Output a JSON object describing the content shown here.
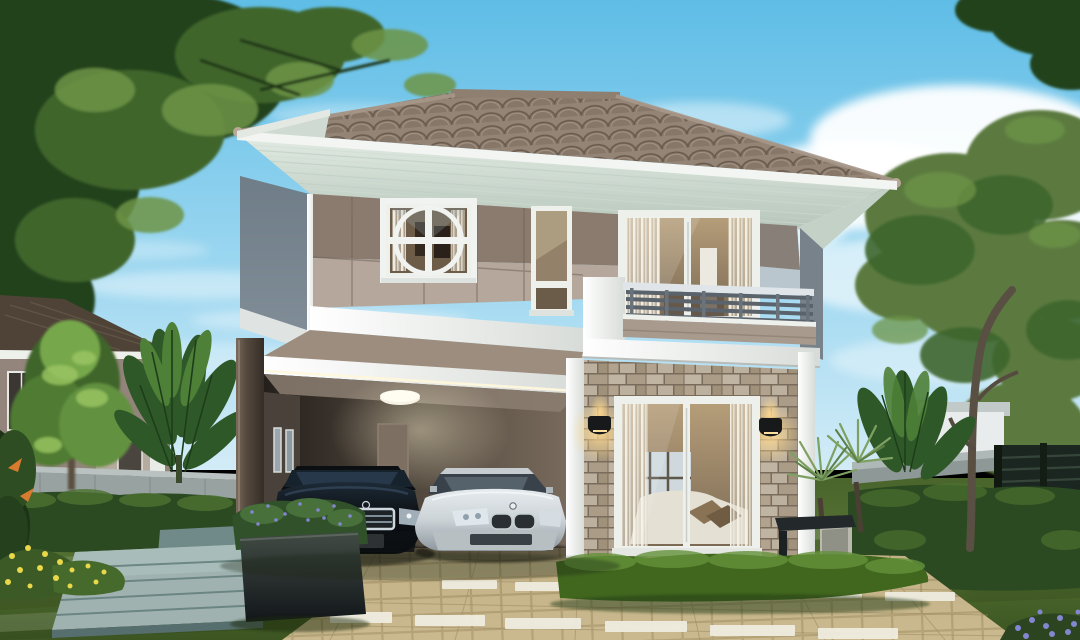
{
  "scene": {
    "description": "Architectural rendering of a modern two-story house at dusk with a carport, two sedans, stone-clad facade, balcony, landscaped garden and paver driveway",
    "objects": {
      "sky": "Blue sky with soft clouds",
      "left_tree": "Large green tree canopy, top left",
      "right_tree": "Tall olive-green garden tree, right side",
      "neighbor_house": "Neighboring two-story house, left background",
      "perimeter_wall": "Gray concrete perimeter wall",
      "metal_fence": "Dark slatted metal fence, right",
      "main_house": "Two-story house with hip tile roof",
      "roof": "Brown concrete tile hip roof with finials",
      "soffit": "White-green striped eave soffit",
      "upper_facade": "Two-tone taupe panel facade",
      "circle_window": "Square window with circular white mullion motif",
      "tall_window": "Tall narrow two-pane window",
      "balcony_door": "White-framed sliding glass door to balcony",
      "balcony": "Balcony with white pillar, metal railing and taupe parapet",
      "carport": "Covered carport with ceiling lamp",
      "ceiling_lamp": "Round ceiling light",
      "black_car": "Black luxury sedan",
      "silver_car": "Silver sedan",
      "stone_wall": "Stacked-stone veneer wall",
      "glass_door": "Large sliding glass door with sheer curtains and living room view",
      "wall_lamps": "Two black wall sconces with warm glow",
      "bench": "Dark-top garden bench on concrete base",
      "driveway": "Tan paver driveway with white accent strips",
      "stepping_stones": "Blue-gray stone platform walk",
      "planter": "Dark planter box with purple-flowering shrubs",
      "yellow_flowers": "Yellow flowering bush on lawn",
      "purple_flowers": "Purple flowers, bottom right corner",
      "hedges": "Trimmed green hedges",
      "lawn": "Mowed green lawn",
      "banana_plants": "Banana and tropical plants",
      "yucca_plants": "Spiky yucca plants near stone wall"
    }
  },
  "palette": {
    "sky-top": "#5fbde6",
    "sky-mid": "#9ad6f0",
    "sky-low": "#d3ecf7",
    "cloud": "#ffffff",
    "roof-base": "#9d8d7e",
    "roof-dark": "#6b5d50",
    "roof-ridge": "#8f7f70",
    "fascia": "#f3f5f2",
    "soffit": "#e3ece4",
    "soffit-line": "#bfcfc3",
    "wall-dark": "#8a7b6e",
    "wall-light": "#b5a79b",
    "wall-side": "#808d97",
    "band-blue": "#b9c6cd",
    "trim-white": "#f0f2ef",
    "stone-base": "#847664",
    "carport-back": "#7b6d5f",
    "carport-dark": "#2a241f",
    "glass-tan": "#93816a",
    "curtain": "#efece2",
    "car-black": "#0d1115",
    "car-silver": "#ccd3d7",
    "chrome": "#cdd7dd",
    "lawn-main": "#567233",
    "lawn-dark": "#3c5522",
    "hedge-dark": "#2c4a21",
    "hedge-light": "#4d7231",
    "tree-dark": "#24421c",
    "tree-mid": "#3f652c",
    "tree-light": "#6d9446",
    "tree-olive": "#5c7a3f",
    "banana-green": "#2f5828",
    "paver": "#c3b186",
    "paver-strip": "#efece0",
    "fence-wall": "#97a2a1",
    "fence-metal": "#1b2620",
    "neighbor-wall": "#93857b",
    "neighbor-roof": "#4f4337",
    "platform-stone": "#9fb2b0",
    "planter-box": "#2c3530",
    "flower-yellow": "#e8d84a",
    "flower-purple": "#8486cf",
    "flower-orange": "#d97b2e",
    "glow-warm": "#ffd98f"
  }
}
